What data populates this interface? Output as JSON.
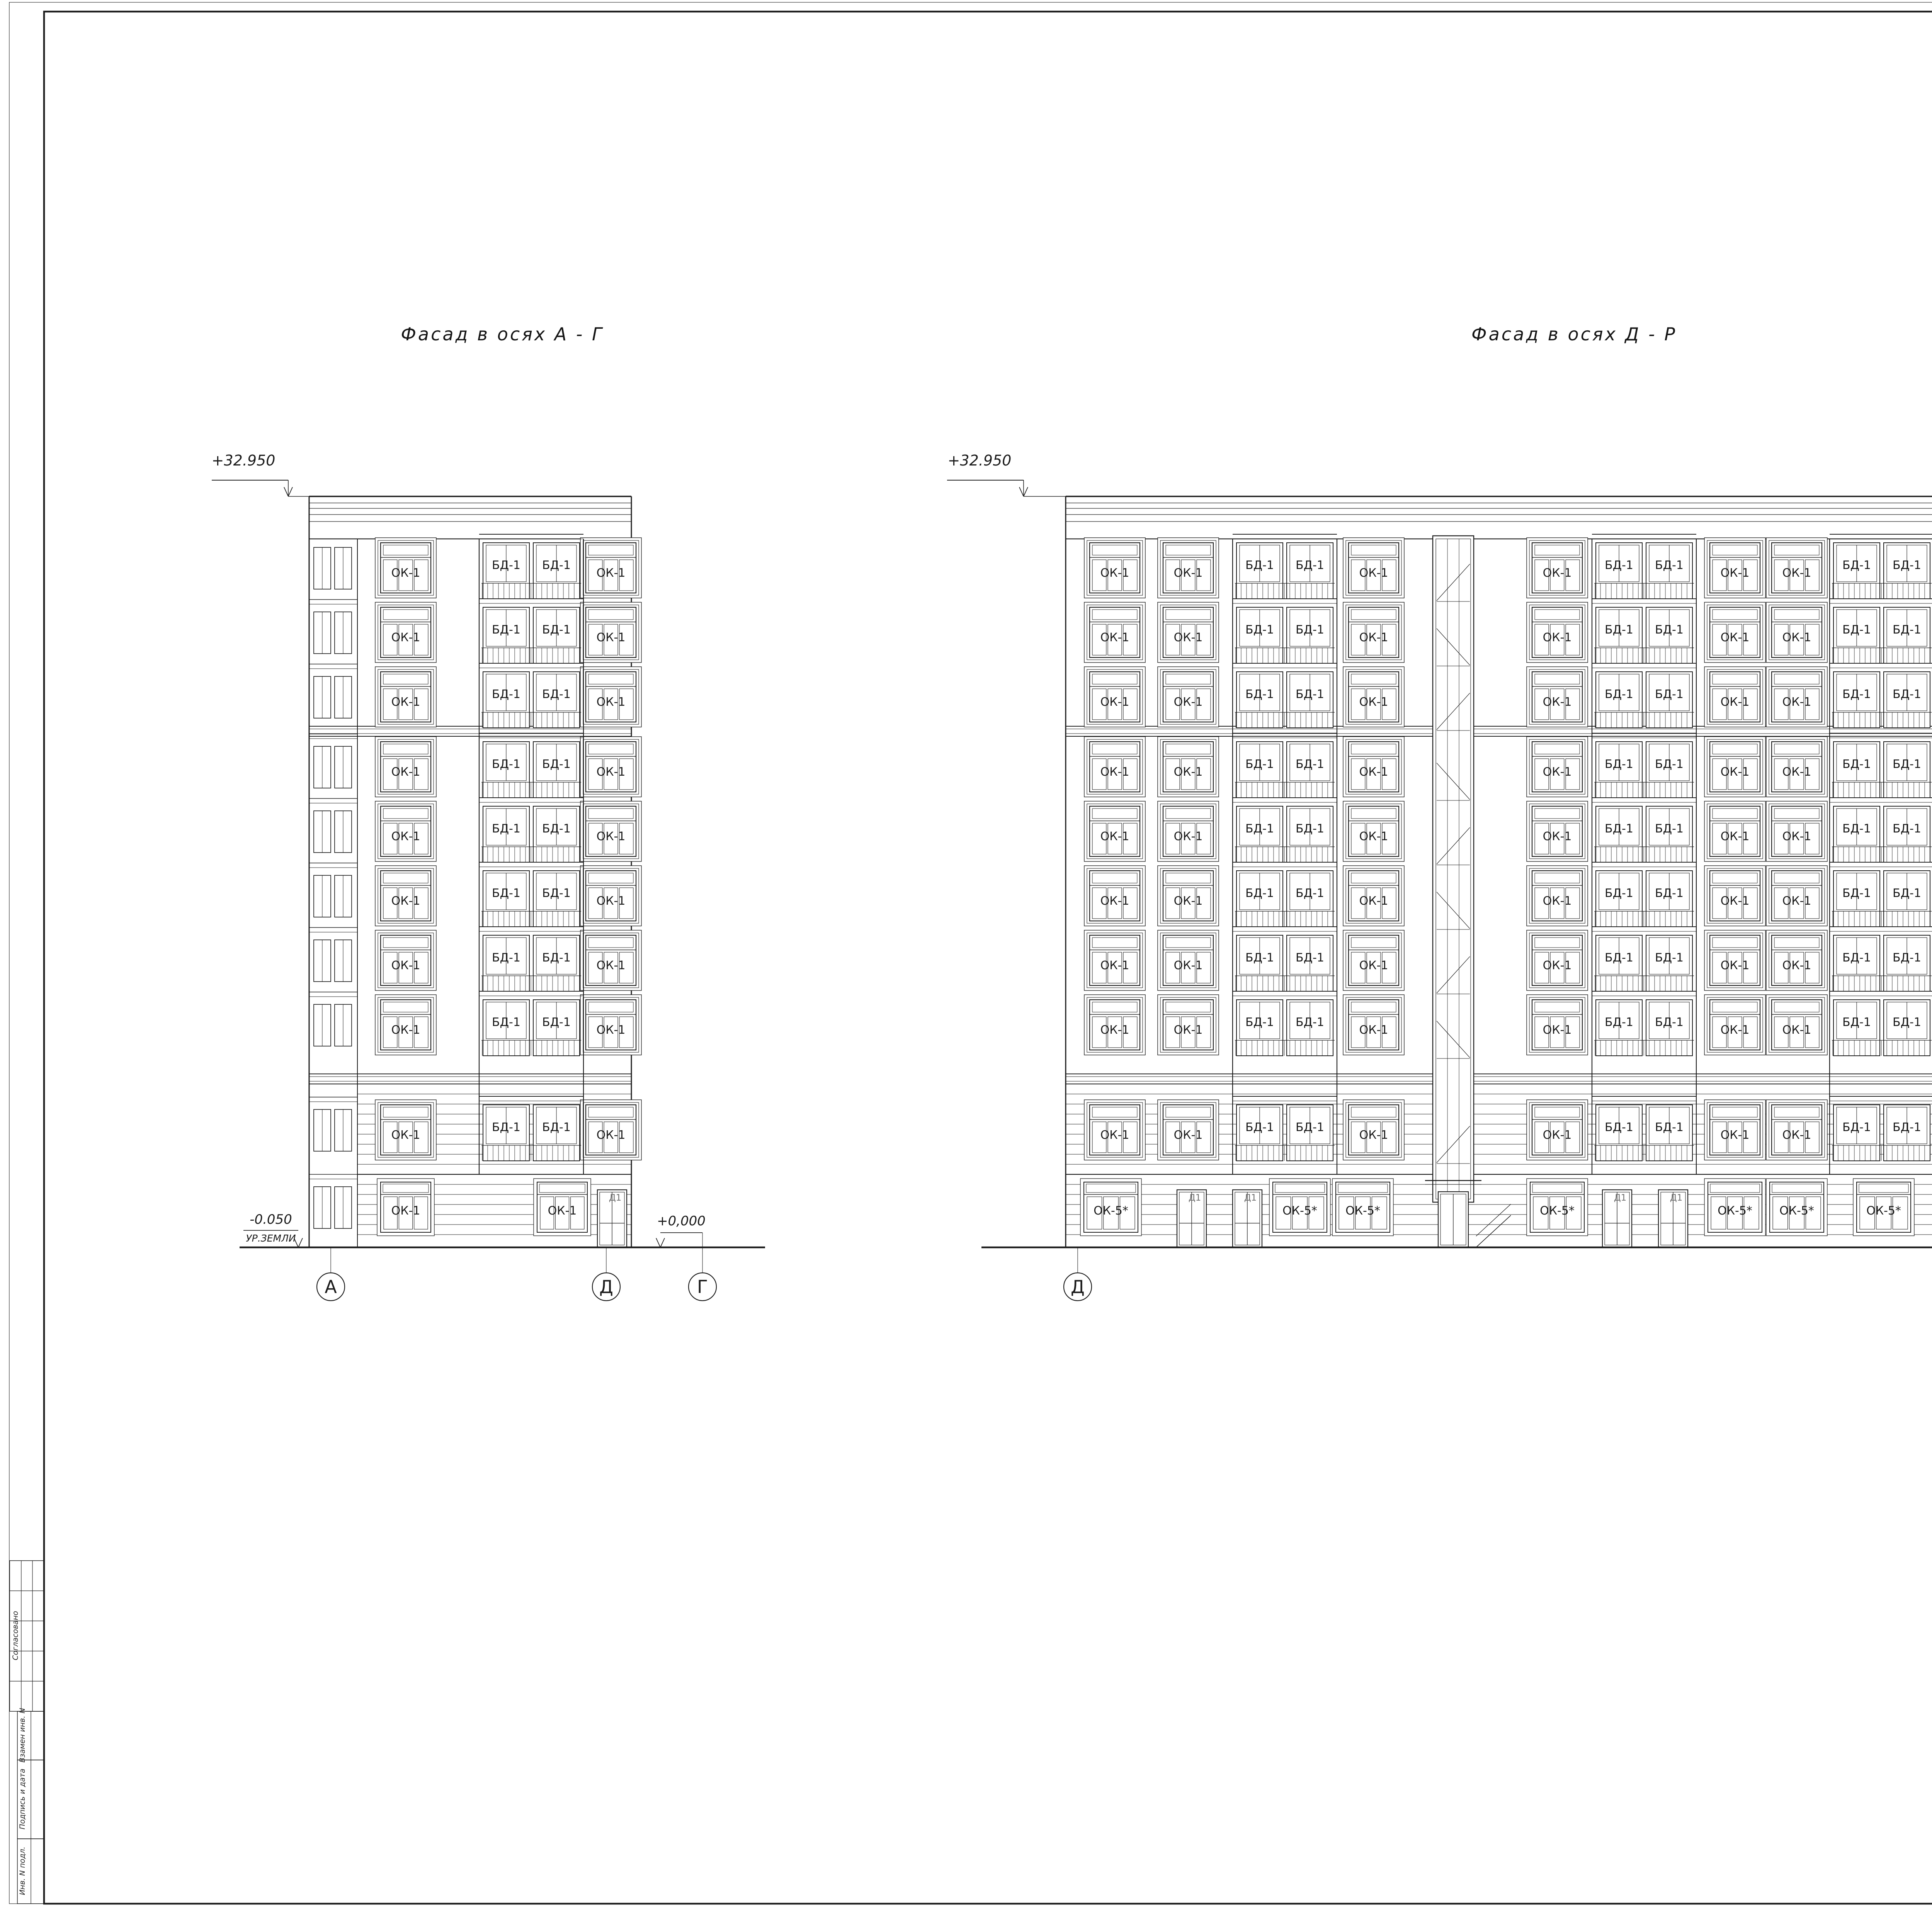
{
  "sheet": {
    "scale_label": "М 1:100",
    "corner_sheet_number": "19",
    "format_label": "Формат А0"
  },
  "margin_blocks": {
    "agreed": "Согласовано",
    "replaced_inv": "Взамен инв. N",
    "sign_and_date": "Подпись и дата",
    "inv_original": "Инв. N подл."
  },
  "window_marks": {
    "ok1": "ОК-1",
    "ok2": "ОК-2",
    "ok2s": "ОК-2*",
    "ok3": "ОК-3",
    "ok5s": "ОК-5*",
    "bd1": "БД-1",
    "d1": "Д1",
    "d12": "Д12"
  },
  "facades": {
    "left": {
      "title": "Фасад в осях А - Г",
      "top_elevation": "+32.950",
      "zero_elevation": "+0,000",
      "ground_elevation": "-0.050",
      "ground_level_label": "УР.ЗЕМЛИ",
      "axes": [
        "А",
        "Д",
        "Г"
      ],
      "floors": 10
    },
    "right": {
      "title": "Фасад в осях Д - Р",
      "top_elevation": "+32.950",
      "zero_elevation": "+0,000",
      "ground_elevation": "-0.050",
      "ground_level_label": "УР.ЗЕМЛИ",
      "axes": [
        "Д",
        "Р"
      ],
      "floors": 10
    }
  },
  "titleblock": {
    "doc_code": "8/4-ПИР-2018-АР.1",
    "project_lines": [
      "Многоквартирный дом со встроенными помещениями,",
      "встроено - пристроенным подземным гаражом по адресу:",
      "Санкт - Петербург, Днепропетровская ул., д. 7, Литера А"
    ],
    "object_name": "Многоквартирный жилой дом",
    "sheet_name_lines": [
      "Фасады в осях А-Г, Д-Р",
      "Маркировочные"
    ],
    "stage_label": "Стадия",
    "sheet_label": "Лист",
    "sheets_label": "Листов",
    "stage_value": "П",
    "sheet_value": "9",
    "header_cols": [
      "Изм.",
      "Кол.уч.",
      "Лист",
      "N док.",
      "Подпись",
      "Дата"
    ],
    "roles": [
      {
        "role": "ГАП",
        "date": "05.18"
      },
      {
        "role": "Разработал",
        "date": "05.18"
      },
      {
        "role": "Норм.контр.",
        "date": "05.18"
      }
    ]
  }
}
